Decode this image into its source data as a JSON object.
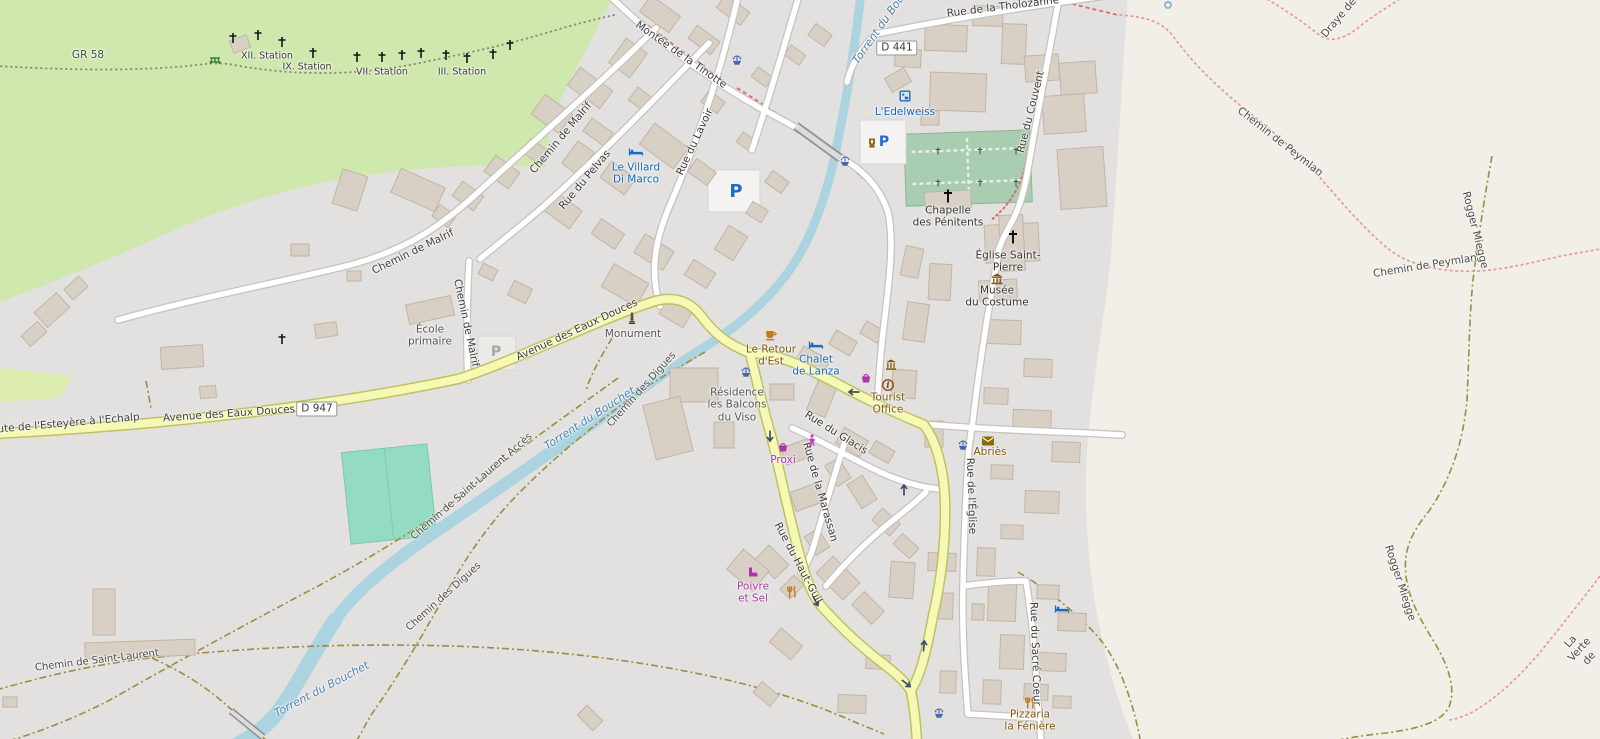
{
  "map": {
    "place": "Abriès",
    "colors": {
      "forest": "#cfe8ae",
      "residential": "#e3e1df",
      "bare_land": "#f2efe9",
      "water": "#abd4e0",
      "main_road": "#f6f9b4",
      "road_casing_main": "#c0c161",
      "building": "#d8d0c5",
      "cemetery": "#a9cdb0",
      "pitch": "#93dcc2",
      "hotel_label": "#1166c0",
      "shop_label": "#ab37ab",
      "food_label": "#7d5709"
    },
    "road_shields": [
      {
        "text": "D 947",
        "x": 317,
        "y": 409
      },
      {
        "text": "D 441",
        "x": 897,
        "y": 48
      }
    ],
    "labels": [
      {
        "t": "GR 58",
        "x": 88,
        "y": 55,
        "r": 0,
        "c": "path-dark"
      },
      {
        "t": "XII. Station",
        "x": 267,
        "y": 56,
        "r": 0,
        "c": "station"
      },
      {
        "t": "IX. Station",
        "x": 307,
        "y": 67,
        "r": 0,
        "c": "station"
      },
      {
        "t": "VII. Station",
        "x": 382,
        "y": 72,
        "r": 0,
        "c": "station"
      },
      {
        "t": "III. Station",
        "x": 462,
        "y": 72,
        "r": 0,
        "c": "station"
      },
      {
        "t": "Montée de la Tinotte",
        "x": 681,
        "y": 55,
        "r": 35,
        "c": "road"
      },
      {
        "t": "Rue du Lavoir",
        "x": 695,
        "y": 142,
        "r": -65,
        "c": "road"
      },
      {
        "t": "Rue du Pelvas",
        "x": 585,
        "y": 180,
        "r": -50,
        "c": "road"
      },
      {
        "t": "Chemin de Malrif",
        "x": 561,
        "y": 138,
        "r": -50,
        "c": "road"
      },
      {
        "t": "Chemin de Malrif",
        "x": 413,
        "y": 252,
        "r": -26,
        "c": "road"
      },
      {
        "t": "Chemin de Malrif",
        "x": 466,
        "y": 323,
        "r": 78,
        "c": "road"
      },
      {
        "t": "Le Villard\nDi Marco",
        "x": 636,
        "y": 174,
        "r": 0,
        "c": "hotel"
      },
      {
        "t": "École\nprimaire",
        "x": 430,
        "y": 336,
        "r": 0,
        "c": "poi"
      },
      {
        "t": "Avenue des Eaux Douces",
        "x": 577,
        "y": 330,
        "r": -25,
        "c": "road"
      },
      {
        "t": "Monument",
        "x": 633,
        "y": 334,
        "r": 0,
        "c": "poi"
      },
      {
        "t": "Avenue des Eaux Douces",
        "x": 229,
        "y": 414,
        "r": -4,
        "c": "road"
      },
      {
        "t": "Route de l'Esteyère à l'Echalp",
        "x": 62,
        "y": 424,
        "r": -5,
        "c": "road"
      },
      {
        "t": "Rue de la Tholozanne",
        "x": 1003,
        "y": 7,
        "r": -7,
        "c": "road"
      },
      {
        "t": "Torrent du Bouchet",
        "x": 886,
        "y": 20,
        "r": -55,
        "c": "water"
      },
      {
        "t": "L'Edelweiss",
        "x": 905,
        "y": 112,
        "r": 0,
        "c": "hotel"
      },
      {
        "t": "Rue du Couvent",
        "x": 1031,
        "y": 112,
        "r": -76,
        "c": "road"
      },
      {
        "t": "Chapelle\ndes Pénitents",
        "x": 948,
        "y": 217,
        "r": 0,
        "c": "poi-dark"
      },
      {
        "t": "Église Saint-\nPierre",
        "x": 1008,
        "y": 262,
        "r": 0,
        "c": "poi-dark"
      },
      {
        "t": "Musée\ndu Costume",
        "x": 997,
        "y": 297,
        "r": 0,
        "c": "poi-dark"
      },
      {
        "t": "Le Retour\nd'Est",
        "x": 771,
        "y": 356,
        "r": 0,
        "c": "food"
      },
      {
        "t": "Chalet\nde Lanza",
        "x": 816,
        "y": 366,
        "r": 0,
        "c": "hotel"
      },
      {
        "t": "Résidence\nles Balcons\ndu Viso",
        "x": 737,
        "y": 405,
        "r": 0,
        "c": "poi"
      },
      {
        "t": "Tourist\nOffice",
        "x": 888,
        "y": 404,
        "r": 0,
        "c": "food"
      },
      {
        "t": "Rue du Glacis",
        "x": 836,
        "y": 433,
        "r": 32,
        "c": "road"
      },
      {
        "t": "Proxi",
        "x": 783,
        "y": 460,
        "r": 0,
        "c": "shop"
      },
      {
        "t": "Abriès",
        "x": 990,
        "y": 452,
        "r": 0,
        "c": "food"
      },
      {
        "t": "Rue de l'Église",
        "x": 971,
        "y": 496,
        "r": 88,
        "c": "road"
      },
      {
        "t": "Rue du Sacré Coeur",
        "x": 1035,
        "y": 654,
        "r": 88,
        "c": "road"
      },
      {
        "t": "Pizzaria\nla Fénière",
        "x": 1030,
        "y": 721,
        "r": 0,
        "c": "food"
      },
      {
        "t": "Poivre\net Sel",
        "x": 753,
        "y": 593,
        "r": 0,
        "c": "shop"
      },
      {
        "t": "Rue du Haut-Guil",
        "x": 798,
        "y": 563,
        "r": 62,
        "c": "road"
      },
      {
        "t": "Rue de la Marassan",
        "x": 820,
        "y": 492,
        "r": 74,
        "c": "road"
      },
      {
        "t": "Chemin de Saint-Laurent Accès",
        "x": 472,
        "y": 487,
        "r": -41,
        "c": "road-sm"
      },
      {
        "t": "Torrent du Bouchet",
        "x": 590,
        "y": 419,
        "r": -33,
        "c": "water"
      },
      {
        "t": "Chemin des Digues",
        "x": 642,
        "y": 390,
        "r": -48,
        "c": "road-sm"
      },
      {
        "t": "Chemin des Digues",
        "x": 444,
        "y": 597,
        "r": -42,
        "c": "road-sm"
      },
      {
        "t": "Chemin de Saint-Laurent",
        "x": 97,
        "y": 661,
        "r": -7,
        "c": "road-sm"
      },
      {
        "t": "Torrent du Bouchet",
        "x": 322,
        "y": 690,
        "r": -28,
        "c": "water"
      },
      {
        "t": "Chemin de Peymlan",
        "x": 1280,
        "y": 142,
        "r": 38,
        "c": "path"
      },
      {
        "t": "Chemin de Peymlan",
        "x": 1425,
        "y": 266,
        "r": -9,
        "c": "path"
      },
      {
        "t": "Rogger Miegge",
        "x": 1475,
        "y": 230,
        "r": 76,
        "c": "path"
      },
      {
        "t": "Rogger Miegge",
        "x": 1400,
        "y": 583,
        "r": 72,
        "c": "path"
      },
      {
        "t": "La Verte de",
        "x": 1580,
        "y": 650,
        "r": -48,
        "c": "path"
      },
      {
        "t": "Draye de",
        "x": 1339,
        "y": 18,
        "r": -50,
        "c": "path"
      }
    ],
    "icons": [
      {
        "n": "picnic-icon",
        "x": 215,
        "y": 60
      },
      {
        "n": "station-cross-icon",
        "x": 233,
        "y": 38
      },
      {
        "n": "station-cross-icon",
        "x": 258,
        "y": 35
      },
      {
        "n": "station-cross-icon",
        "x": 282,
        "y": 42
      },
      {
        "n": "station-cross-icon",
        "x": 313,
        "y": 53
      },
      {
        "n": "station-cross-icon",
        "x": 357,
        "y": 57
      },
      {
        "n": "station-cross-icon",
        "x": 382,
        "y": 57
      },
      {
        "n": "station-cross-icon",
        "x": 402,
        "y": 55
      },
      {
        "n": "station-cross-icon",
        "x": 421,
        "y": 53
      },
      {
        "n": "station-cross-icon",
        "x": 446,
        "y": 55
      },
      {
        "n": "station-cross-icon",
        "x": 467,
        "y": 58
      },
      {
        "n": "station-cross-icon",
        "x": 493,
        "y": 54
      },
      {
        "n": "station-cross-icon",
        "x": 510,
        "y": 45
      },
      {
        "n": "station-cross-icon",
        "x": 282,
        "y": 339
      },
      {
        "n": "church-cross-icon",
        "x": 948,
        "y": 196
      },
      {
        "n": "church-cross-icon",
        "x": 1013,
        "y": 237
      },
      {
        "n": "grave-cross-icon",
        "x": 938,
        "y": 151
      },
      {
        "n": "grave-cross-icon",
        "x": 980,
        "y": 151
      },
      {
        "n": "grave-cross-icon",
        "x": 1016,
        "y": 151
      },
      {
        "n": "grave-cross-icon",
        "x": 938,
        "y": 183
      },
      {
        "n": "grave-cross-icon",
        "x": 980,
        "y": 183
      },
      {
        "n": "grave-cross-icon",
        "x": 1016,
        "y": 183
      },
      {
        "n": "fountain-icon",
        "x": 737,
        "y": 60
      },
      {
        "n": "fountain-icon",
        "x": 845,
        "y": 161
      },
      {
        "n": "fountain-icon",
        "x": 746,
        "y": 372
      },
      {
        "n": "fountain-icon",
        "x": 963,
        "y": 445
      },
      {
        "n": "fountain-icon",
        "x": 939,
        "y": 713
      },
      {
        "n": "parking-icon-large",
        "x": 736,
        "y": 192
      },
      {
        "n": "parking-icon",
        "x": 884,
        "y": 142
      },
      {
        "n": "parking-icon-grey",
        "x": 496,
        "y": 352
      },
      {
        "n": "lamp-icon",
        "x": 872,
        "y": 143
      },
      {
        "n": "hostel-icon",
        "x": 905,
        "y": 96
      },
      {
        "n": "bed-icon",
        "x": 636,
        "y": 152
      },
      {
        "n": "bed-icon",
        "x": 816,
        "y": 345
      },
      {
        "n": "bed-icon",
        "x": 1062,
        "y": 609
      },
      {
        "n": "cafe-icon",
        "x": 771,
        "y": 335
      },
      {
        "n": "restaurant-icon",
        "x": 792,
        "y": 592
      },
      {
        "n": "restaurant-icon",
        "x": 1030,
        "y": 703
      },
      {
        "n": "museum-icon",
        "x": 997,
        "y": 279
      },
      {
        "n": "townhall-icon",
        "x": 891,
        "y": 365
      },
      {
        "n": "info-icon",
        "x": 888,
        "y": 385
      },
      {
        "n": "basket-icon",
        "x": 866,
        "y": 378
      },
      {
        "n": "basket-icon",
        "x": 783,
        "y": 447
      },
      {
        "n": "person-icon",
        "x": 812,
        "y": 440
      },
      {
        "n": "shoe-icon",
        "x": 752,
        "y": 572
      },
      {
        "n": "envelope-icon",
        "x": 988,
        "y": 441
      },
      {
        "n": "monument-icon",
        "x": 632,
        "y": 318
      },
      {
        "n": "blue-ring-icon",
        "x": 1168,
        "y": 5
      },
      {
        "n": "oneway-arrow-icon",
        "x": 853,
        "y": 392,
        "r": 180
      },
      {
        "n": "oneway-arrow-icon",
        "x": 770,
        "y": 437,
        "r": 90
      },
      {
        "n": "oneway-arrow-icon",
        "x": 904,
        "y": 489,
        "r": -90
      },
      {
        "n": "oneway-arrow-icon",
        "x": 816,
        "y": 602,
        "r": 62
      },
      {
        "n": "oneway-arrow-icon",
        "x": 924,
        "y": 645,
        "r": -85
      },
      {
        "n": "oneway-arrow-icon",
        "x": 907,
        "y": 684,
        "r": 38
      }
    ]
  }
}
